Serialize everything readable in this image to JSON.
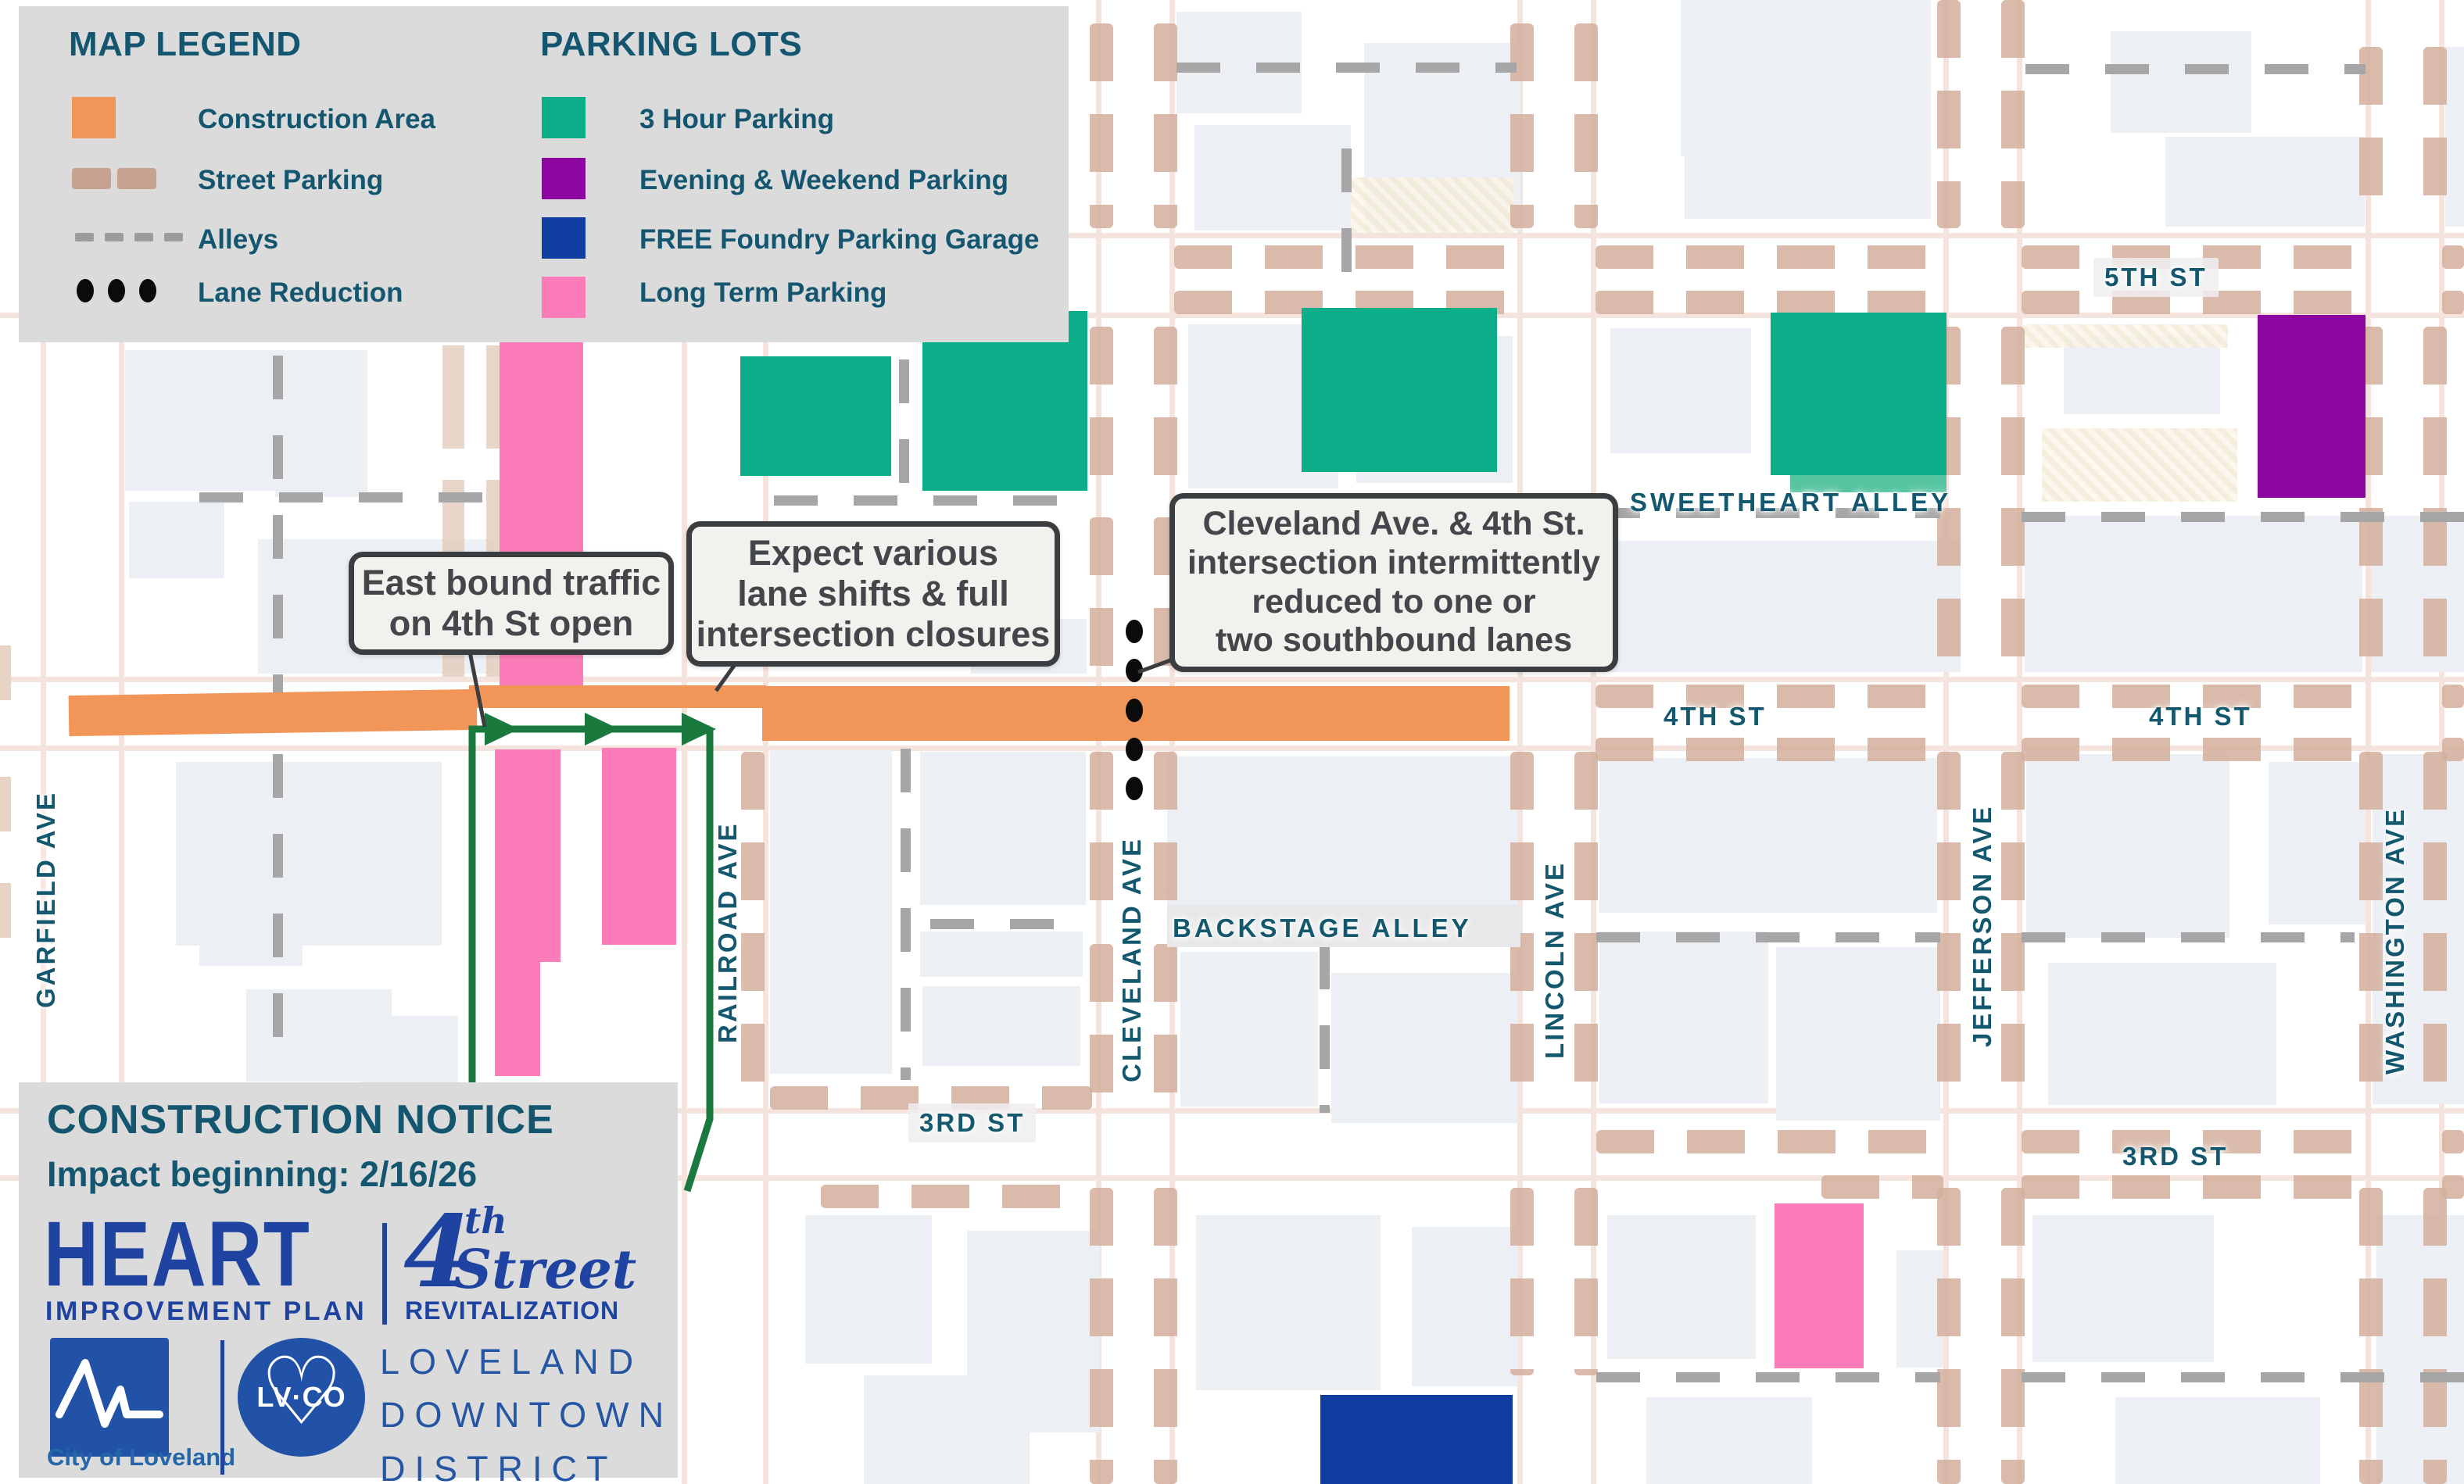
{
  "legend": {
    "title": "MAP LEGEND",
    "items": [
      {
        "label": "Construction Area",
        "color": "#F29559"
      },
      {
        "label": "Street Parking",
        "color": "#C8A290"
      },
      {
        "label": "Alleys",
        "color": "#9C9C9C"
      },
      {
        "label": "Lane Reduction",
        "color": "#0B0B0B"
      }
    ]
  },
  "parking": {
    "title": "PARKING LOTS",
    "items": [
      {
        "label": "3 Hour Parking",
        "color": "#0BAE89"
      },
      {
        "label": "Evening & Weekend Parking",
        "color": "#8E06A0"
      },
      {
        "label": "FREE Foundry Parking Garage",
        "color": "#103D9F"
      },
      {
        "label": "Long Term Parking",
        "color": "#FB7CB8"
      }
    ]
  },
  "callouts": {
    "eastbound": {
      "line1": "East bound traffic",
      "line2": "on 4th St open"
    },
    "laneshifts": {
      "line1": "Expect various",
      "line2": "lane shifts & full",
      "line3": "intersection closures"
    },
    "cleveland": {
      "line1": "Cleveland Ave. & 4th St.",
      "line2": "intersection intermittently",
      "line3": "reduced to one or",
      "line4": "two southbound lanes"
    }
  },
  "streets": {
    "garfield": "GARFIELD AVE",
    "railroad": "RAILROAD AVE",
    "cleveland": "CLEVELAND AVE",
    "lincoln": "LINCOLN AVE",
    "jefferson": "JEFFERSON AVE",
    "washington": "WASHINGTON AVE",
    "fifth": "5TH ST",
    "fourth_mid": "4TH ST",
    "fourth_east": "4TH ST",
    "third_west": "3RD ST",
    "third_east": "3RD ST",
    "sweetheart": "SWEETHEART ALLEY",
    "backstage": "BACKSTAGE ALLEY"
  },
  "notice": {
    "title": "CONSTRUCTION NOTICE",
    "impact": "Impact beginning: 2/16/26"
  },
  "logos": {
    "heart": "HEART",
    "heart_sub": "IMPROVEMENT PLAN",
    "four": "4",
    "four_th": "th",
    "four_street": "Street",
    "four_sub": "REVITALIZATION",
    "city": "City of Loveland",
    "lvco": "LV·CO",
    "ldd_line1": "LOVELAND",
    "ldd_line2": "DOWNTOWN",
    "ldd_line3": "DISTRICT"
  },
  "colors": {
    "construction": "#F29559",
    "street_parking": "#D6B6A4",
    "alley": "#9C9C9C",
    "lane_dot": "#0B0B0B",
    "route_green": "#1A7A3E",
    "label_teal": "#14586F",
    "brand_blue": "#1E43A0"
  }
}
